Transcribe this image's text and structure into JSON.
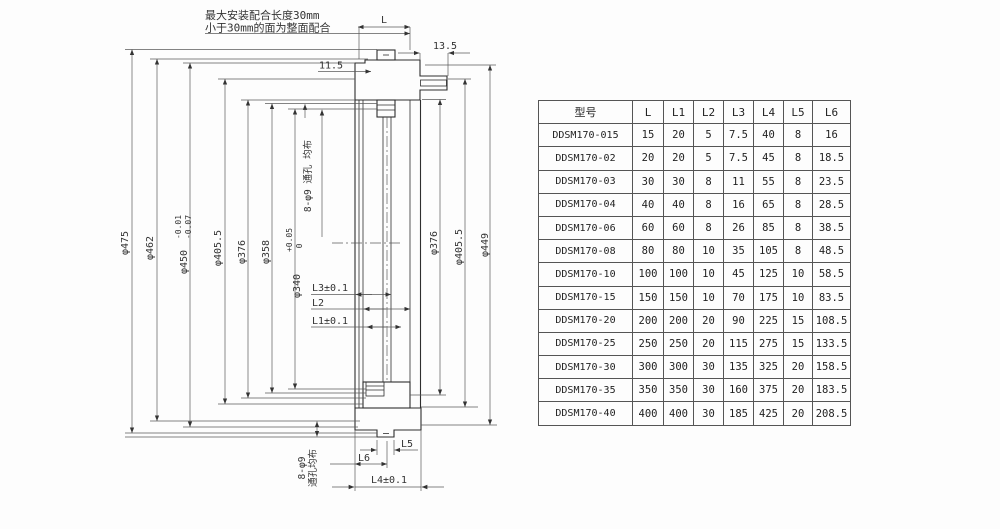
{
  "drawing": {
    "note_line1": "最大安装配合长度30mm",
    "note_line2": "小于30mm的面为整面配合",
    "hole_note_mid": "8-φ9 通孔 均布",
    "hole_note_bottom_1": "8-φ9",
    "hole_note_bottom_2": "通孔均布",
    "dia_left": {
      "d475": "φ475",
      "d462": "φ462",
      "d450": "φ450",
      "d450_tol_u": "-0.01",
      "d450_tol_l": "-0.07",
      "d405": "φ405.5",
      "d376": "φ376",
      "d358": "φ358",
      "d340": "φ340",
      "d340_tol_u": "+0.05",
      "d340_tol_l": "0"
    },
    "dia_right": {
      "d376": "φ376",
      "d405": "φ405.5",
      "d449": "φ449"
    },
    "dim_top": {
      "L": "L",
      "v135": "13.5",
      "v115": "11.5"
    },
    "dim_mid": {
      "L3": "L3±0.1",
      "L2": "L2",
      "L1": "L1±0.1"
    },
    "dim_bottom": {
      "L5": "L5",
      "L6": "L6",
      "L4": "L4±0.1"
    }
  },
  "table": {
    "headers": [
      "型号",
      "L",
      "L1",
      "L2",
      "L3",
      "L4",
      "L5",
      "L6"
    ],
    "rows": [
      [
        "DDSM170-015",
        "15",
        "20",
        "5",
        "7.5",
        "40",
        "8",
        "16"
      ],
      [
        "DDSM170-02",
        "20",
        "20",
        "5",
        "7.5",
        "45",
        "8",
        "18.5"
      ],
      [
        "DDSM170-03",
        "30",
        "30",
        "8",
        "11",
        "55",
        "8",
        "23.5"
      ],
      [
        "DDSM170-04",
        "40",
        "40",
        "8",
        "16",
        "65",
        "8",
        "28.5"
      ],
      [
        "DDSM170-06",
        "60",
        "60",
        "8",
        "26",
        "85",
        "8",
        "38.5"
      ],
      [
        "DDSM170-08",
        "80",
        "80",
        "10",
        "35",
        "105",
        "8",
        "48.5"
      ],
      [
        "DDSM170-10",
        "100",
        "100",
        "10",
        "45",
        "125",
        "10",
        "58.5"
      ],
      [
        "DDSM170-15",
        "150",
        "150",
        "10",
        "70",
        "175",
        "10",
        "83.5"
      ],
      [
        "DDSM170-20",
        "200",
        "200",
        "20",
        "90",
        "225",
        "15",
        "108.5"
      ],
      [
        "DDSM170-25",
        "250",
        "250",
        "20",
        "115",
        "275",
        "15",
        "133.5"
      ],
      [
        "DDSM170-30",
        "300",
        "300",
        "30",
        "135",
        "325",
        "20",
        "158.5"
      ],
      [
        "DDSM170-35",
        "350",
        "350",
        "30",
        "160",
        "375",
        "20",
        "183.5"
      ],
      [
        "DDSM170-40",
        "400",
        "400",
        "30",
        "185",
        "425",
        "20",
        "208.5"
      ]
    ]
  }
}
